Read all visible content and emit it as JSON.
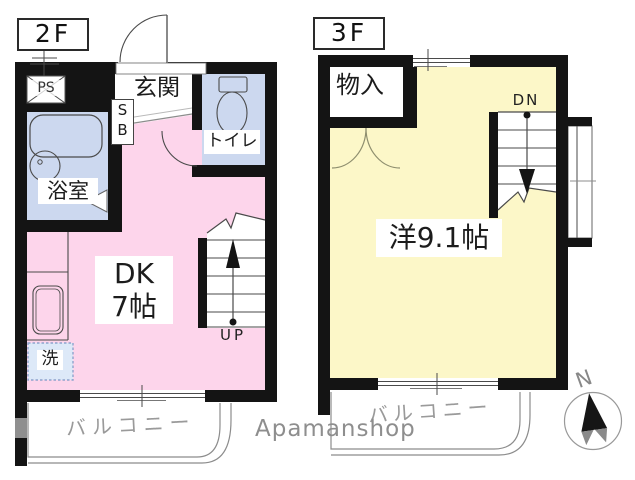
{
  "colors": {
    "wall": "#141414",
    "pink": "#fdd5eb",
    "yellow": "#fcf7c8",
    "blue": "#ccd8ef",
    "washer": "#dde9f8",
    "line": "#4a4a4a",
    "balcony_line": "#8c8c8c",
    "gray_text": "#9a9a9a",
    "watermark": "#8e8e8e",
    "compass_gray": "#8a8a8a"
  },
  "floor2": {
    "label": "2F",
    "ps": "PS",
    "genkan": "玄関",
    "shoe_box": "S\nB",
    "toilet": "トイレ",
    "bath": "浴室",
    "dk": "DK\n7帖",
    "washer": "洗",
    "stairs": "UP",
    "balcony": "バルコニー"
  },
  "floor3": {
    "label": "3F",
    "closet": "物入",
    "stairs": "DN",
    "main_room": "洋9.1帖",
    "balcony": "バルコニー"
  },
  "compass": {
    "north": "N"
  },
  "watermark": "Apamanshop"
}
